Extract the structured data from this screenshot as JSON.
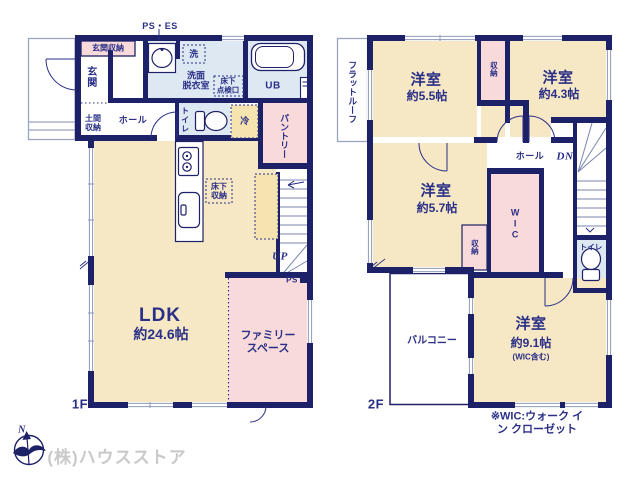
{
  "colors": {
    "wall_navy": "#1d2167",
    "text_navy": "#2a2f87",
    "room_cream": "#f6e8c5",
    "room_pink": "#f9dada",
    "room_blue": "#dde8f3",
    "room_yellow": "#f5e3b0",
    "window_gray": "#8e99b8",
    "company_gray": "#c9c9c9"
  },
  "f1": {
    "floor_label": "1F",
    "ps_es": "PS・ES",
    "genkan_shuno": "玄関収納",
    "genkan": "玄関",
    "doma_shuno": "土間\n収納",
    "hall": "ホール",
    "sen": "洗",
    "senmen": "洗面\n脱衣室",
    "yukashita_tenkenko": "床下\n点検口",
    "ub": "UB",
    "toilet": "トイレ",
    "rei": "冷",
    "pantry": "パントリー",
    "yukashita_shuno": "床下\n収納",
    "up": "UP",
    "ps": "PS",
    "ldk": {
      "name": "LDK",
      "size": "約24.6帖"
    },
    "family_space": "ファミリー\nスペース"
  },
  "f2": {
    "floor_label": "2F",
    "flat_roof": "フラットルーフ",
    "room_55": {
      "name": "洋室",
      "size": "約5.5帖"
    },
    "room_43": {
      "name": "洋室",
      "size": "約4.3帖"
    },
    "room_57": {
      "name": "洋室",
      "size": "約5.7帖"
    },
    "room_91": {
      "name": "洋室",
      "size": "約9.1帖",
      "note": "(WIC含む)"
    },
    "shuno_top": "収納",
    "shuno_mid": "収納",
    "wic": "WIC",
    "hall": "ホール",
    "dn": "DN",
    "toilet": "トイレ",
    "balcony": "バルコニー"
  },
  "footer": {
    "wic_note": "※WIC:ウォーク イン クローゼット",
    "company": "(株)ハウスストア",
    "compass_n": "N"
  }
}
